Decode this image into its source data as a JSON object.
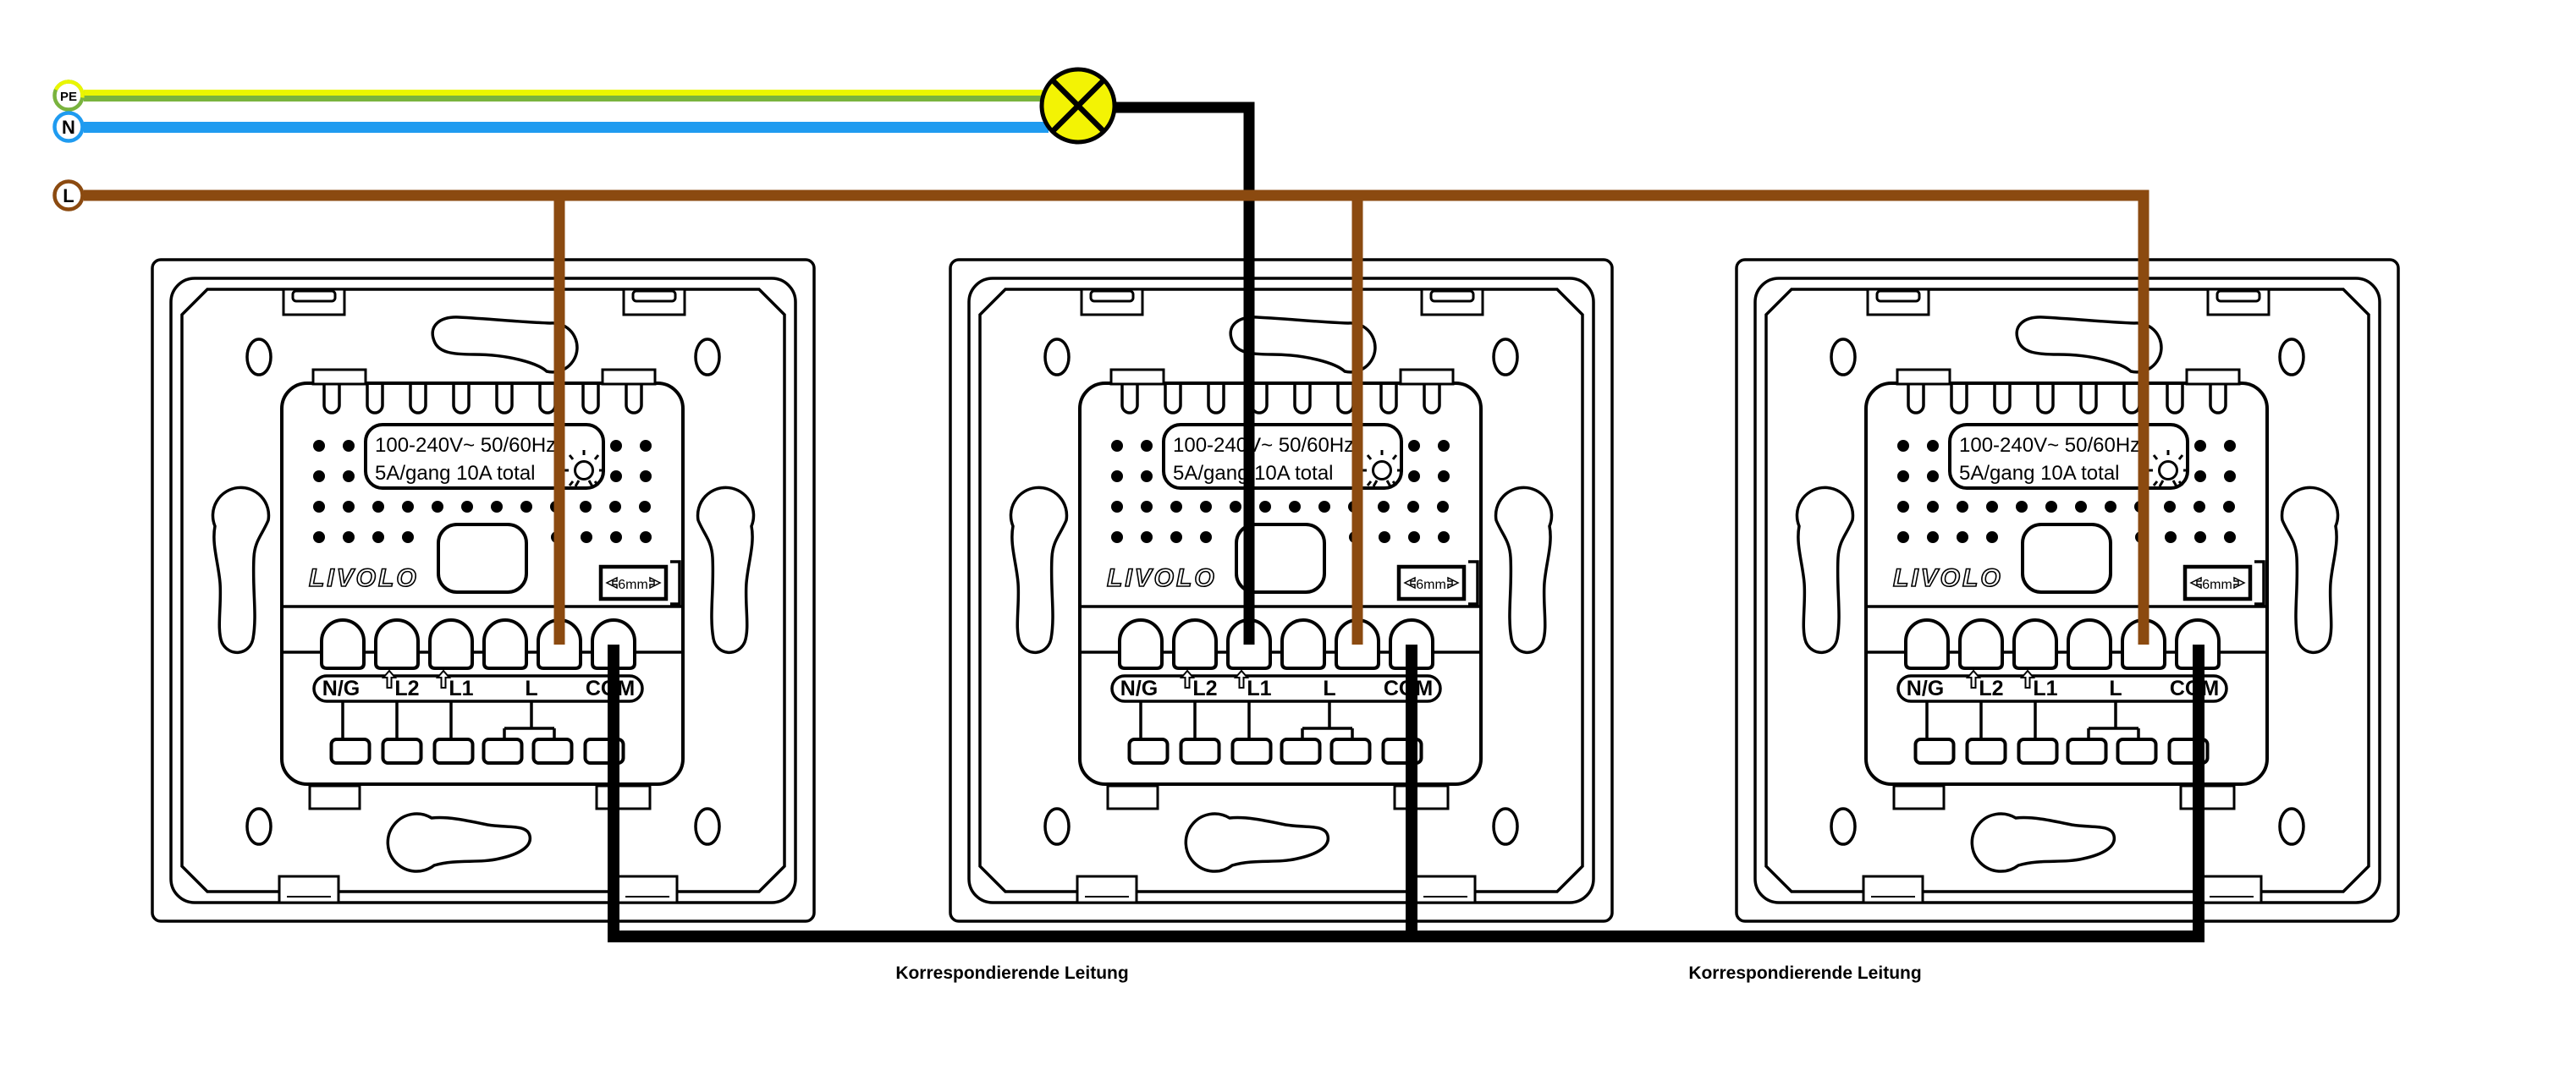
{
  "wires": {
    "pe_label": "PE",
    "neutral_label": "N",
    "live_label": "L"
  },
  "colors": {
    "pe_yellow": "#eaf600",
    "pe_green": "#79b33e",
    "neutral_blue": "#1f9bf0",
    "live_brown": "#8b4a10",
    "lamp_yellow": "#f3f304",
    "wire_black": "#000000"
  },
  "switch": {
    "brand": "LIVOLO",
    "rating_line1": "100-240V~ 50/60Hz",
    "rating_line2": "5A/gang 10A total",
    "strip_gauge": "6mm",
    "terminal_labels": {
      "ng": "N/G",
      "l2": "L2",
      "l1": "L1",
      "l": "L",
      "com": "COM"
    }
  },
  "annotations": {
    "corresponding_line_1": "Korrespondierende Leitung",
    "corresponding_line_2": "Korrespondierende Leitung"
  }
}
